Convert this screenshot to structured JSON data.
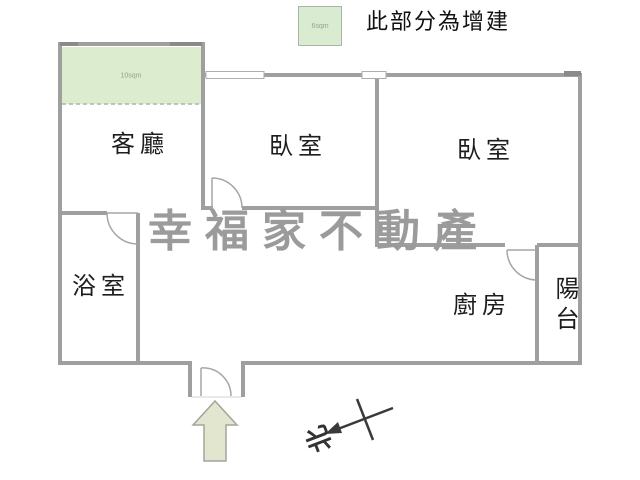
{
  "legend": {
    "swatch_area": "6sqm",
    "label": "此部分為增建"
  },
  "watermark_text": "幸福家不動產",
  "rooms": {
    "living_room": "客廳",
    "bedroom_left": "臥室",
    "bedroom_right": "臥室",
    "bathroom": "浴室",
    "kitchen": "廚房",
    "balcony": "陽台",
    "addition_area": "10sqm"
  },
  "compass": {
    "north": "北"
  },
  "colors": {
    "wall": "#9f9f9f",
    "addition_fill": "#dbeccf",
    "arrow_fill": "#e3e6ce",
    "watermark": "#9b9b9b",
    "compass": "#3a3a3a"
  }
}
